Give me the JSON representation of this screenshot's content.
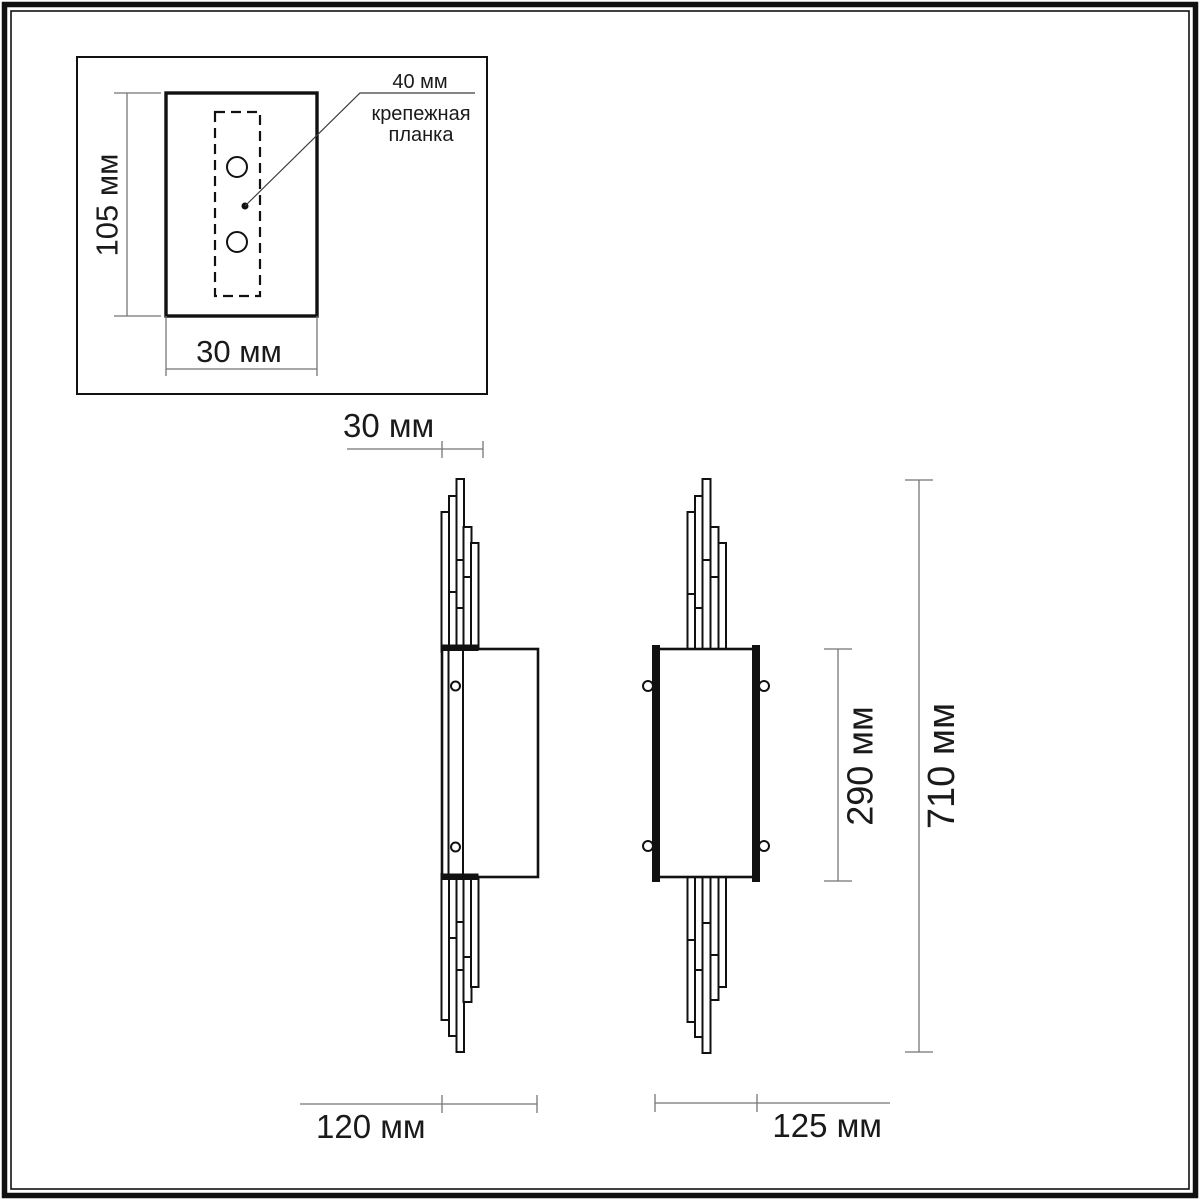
{
  "diagram": {
    "inset": {
      "height": "105 мм",
      "width": "30 мм",
      "leader_value": "40 мм",
      "leader_caption": [
        "крепежная",
        "планка"
      ]
    },
    "main": {
      "depth": "30 мм",
      "side_view_width": "120 мм",
      "front_view_width": "125 мм",
      "shade_height": "290 мм",
      "total_height": "710 мм"
    }
  },
  "colors": {
    "outline": "#111111",
    "dim_line": "#757575",
    "text_color": "#1a1a1a",
    "background": "#ffffff"
  }
}
